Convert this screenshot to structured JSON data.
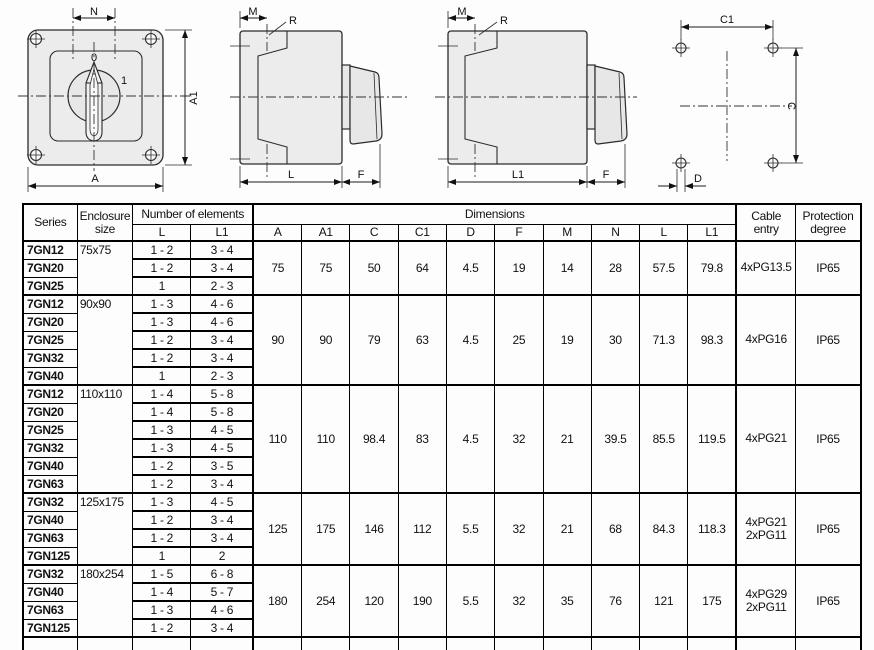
{
  "drawings": {
    "front_view": {
      "dim_n": "N",
      "dim_a1": "A1",
      "dim_a": "A",
      "pos_0": "0",
      "pos_1": "1"
    },
    "side_view_short": {
      "dim_m": "M",
      "ref_r": "R",
      "dim_l": "L",
      "dim_f": "F"
    },
    "side_view_long": {
      "dim_m": "M",
      "ref_r": "R",
      "dim_l1": "L1",
      "dim_f": "F"
    },
    "drill_pattern": {
      "dim_c1": "C1",
      "dim_c": "C",
      "dim_d": "D"
    }
  },
  "table": {
    "headers": {
      "series": "Series",
      "enclosure": "Enclosure size",
      "elements": "Number of elements",
      "elements_l": "L",
      "elements_l1": "L1",
      "dimensions": "Dimensions",
      "dim_cols": [
        "A",
        "A1",
        "C",
        "C1",
        "D",
        "F",
        "M",
        "N",
        "L",
        "L1"
      ],
      "cable": "Cable entry",
      "protection": "Protection degree"
    },
    "groups": [
      {
        "enclosure": "75x75",
        "rows": [
          {
            "series": "7GN12",
            "l": "1 - 2",
            "l1": "3 - 4"
          },
          {
            "series": "7GN20",
            "l": "1 - 2",
            "l1": "3 - 4"
          },
          {
            "series": "7GN25",
            "l": "1",
            "l1": "2 - 3"
          }
        ],
        "dims": [
          "75",
          "75",
          "50",
          "64",
          "4.5",
          "19",
          "14",
          "28",
          "57.5",
          "79.8"
        ],
        "cable": "4xPG13.5",
        "protection": "IP65"
      },
      {
        "enclosure": "90x90",
        "rows": [
          {
            "series": "7GN12",
            "l": "1 - 3",
            "l1": "4 - 6"
          },
          {
            "series": "7GN20",
            "l": "1 - 3",
            "l1": "4 - 6"
          },
          {
            "series": "7GN25",
            "l": "1 - 2",
            "l1": "3 - 4"
          },
          {
            "series": "7GN32",
            "l": "1 - 2",
            "l1": "3 - 4"
          },
          {
            "series": "7GN40",
            "l": "1",
            "l1": "2 - 3"
          }
        ],
        "dims": [
          "90",
          "90",
          "79",
          "63",
          "4.5",
          "25",
          "19",
          "30",
          "71.3",
          "98.3"
        ],
        "cable": "4xPG16",
        "protection": "IP65"
      },
      {
        "enclosure": "110x110",
        "rows": [
          {
            "series": "7GN12",
            "l": "1 - 4",
            "l1": "5 - 8"
          },
          {
            "series": "7GN20",
            "l": "1 - 4",
            "l1": "5 - 8"
          },
          {
            "series": "7GN25",
            "l": "1 - 3",
            "l1": "4 - 5"
          },
          {
            "series": "7GN32",
            "l": "1 - 3",
            "l1": "4 - 5"
          },
          {
            "series": "7GN40",
            "l": "1 - 2",
            "l1": "3 - 5"
          },
          {
            "series": "7GN63",
            "l": "1 - 2",
            "l1": "3 - 4"
          }
        ],
        "dims": [
          "110",
          "110",
          "98.4",
          "83",
          "4.5",
          "32",
          "21",
          "39.5",
          "85.5",
          "119.5"
        ],
        "cable": "4xPG21",
        "protection": "IP65"
      },
      {
        "enclosure": "125x175",
        "rows": [
          {
            "series": "7GN32",
            "l": "1 - 3",
            "l1": "4 - 5"
          },
          {
            "series": "7GN40",
            "l": "1 - 2",
            "l1": "3 - 4"
          },
          {
            "series": "7GN63",
            "l": "1 - 2",
            "l1": "3 - 4"
          },
          {
            "series": "7GN125",
            "l": "1",
            "l1": "2"
          }
        ],
        "dims": [
          "125",
          "175",
          "146",
          "112",
          "5.5",
          "32",
          "21",
          "68",
          "84.3",
          "118.3"
        ],
        "cable": "4xPG21\n2xPG11",
        "protection": "IP65"
      },
      {
        "enclosure": "180x254",
        "rows": [
          {
            "series": "7GN32",
            "l": "1 - 5",
            "l1": "6 - 8"
          },
          {
            "series": "7GN40",
            "l": "1 - 4",
            "l1": "5 - 7"
          },
          {
            "series": "7GN63",
            "l": "1 - 3",
            "l1": "4 - 6"
          },
          {
            "series": "7GN125",
            "l": "1 - 2",
            "l1": "3 - 4"
          }
        ],
        "dims": [
          "180",
          "254",
          "120",
          "190",
          "5.5",
          "32",
          "35",
          "76",
          "121",
          "175"
        ],
        "cable": "4xPG29\n2xPG11",
        "protection": "IP65"
      }
    ]
  }
}
